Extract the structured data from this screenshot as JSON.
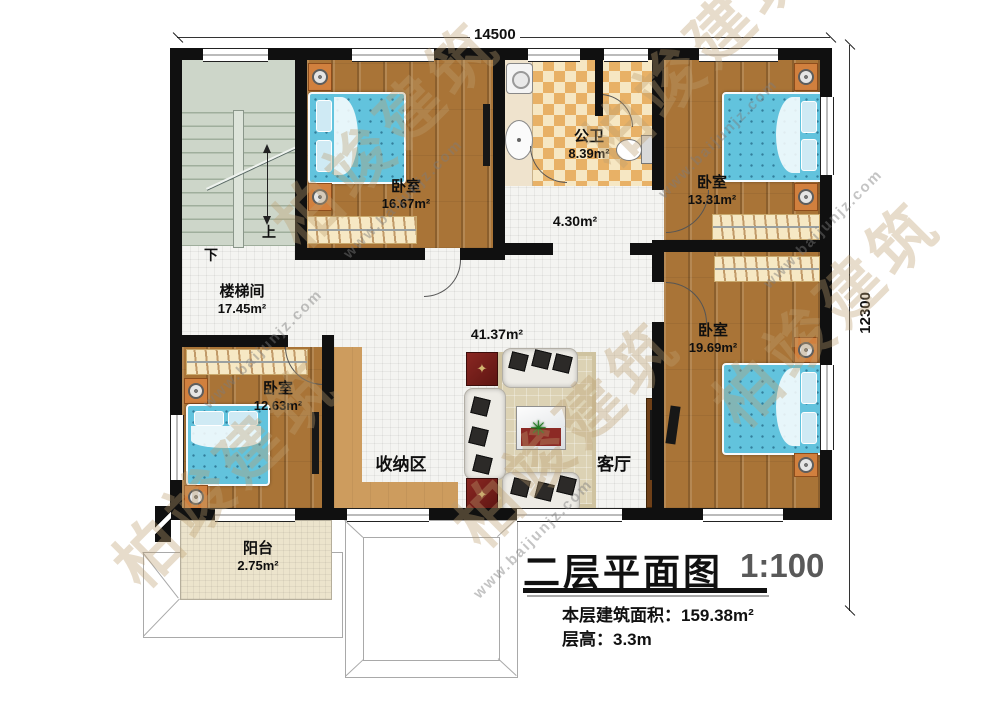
{
  "dimensions": {
    "width_label": "14500",
    "height_label": "12300"
  },
  "title_block": {
    "title": "二层平面图",
    "scale": "1:100",
    "area_line": "本层建筑面积：159.38m²",
    "height_line": "层高：3.3m"
  },
  "rooms": {
    "stairwell": {
      "name": "楼梯间",
      "area": "17.45m²",
      "up": "上",
      "down": "下"
    },
    "bedroom_top_left": {
      "name": "卧室",
      "area": "16.67m²"
    },
    "bathroom": {
      "name": "公卫",
      "area": "8.39m²"
    },
    "hallway": {
      "area": "4.30m²"
    },
    "bedroom_top_right": {
      "name": "卧室",
      "area": "13.31m²"
    },
    "bedroom_mid_right": {
      "name": "卧室",
      "area": "19.69m²"
    },
    "bedroom_bottom_left": {
      "name": "卧室",
      "area": "12.63m²"
    },
    "living": {
      "hall_area": "41.37m²",
      "storage_label": "收纳区",
      "living_label": "客厅"
    },
    "balcony": {
      "name": "阳台",
      "area": "2.75m²"
    }
  },
  "watermark": {
    "brand": "柏竣建筑",
    "url": "www.baijunjz.com"
  }
}
